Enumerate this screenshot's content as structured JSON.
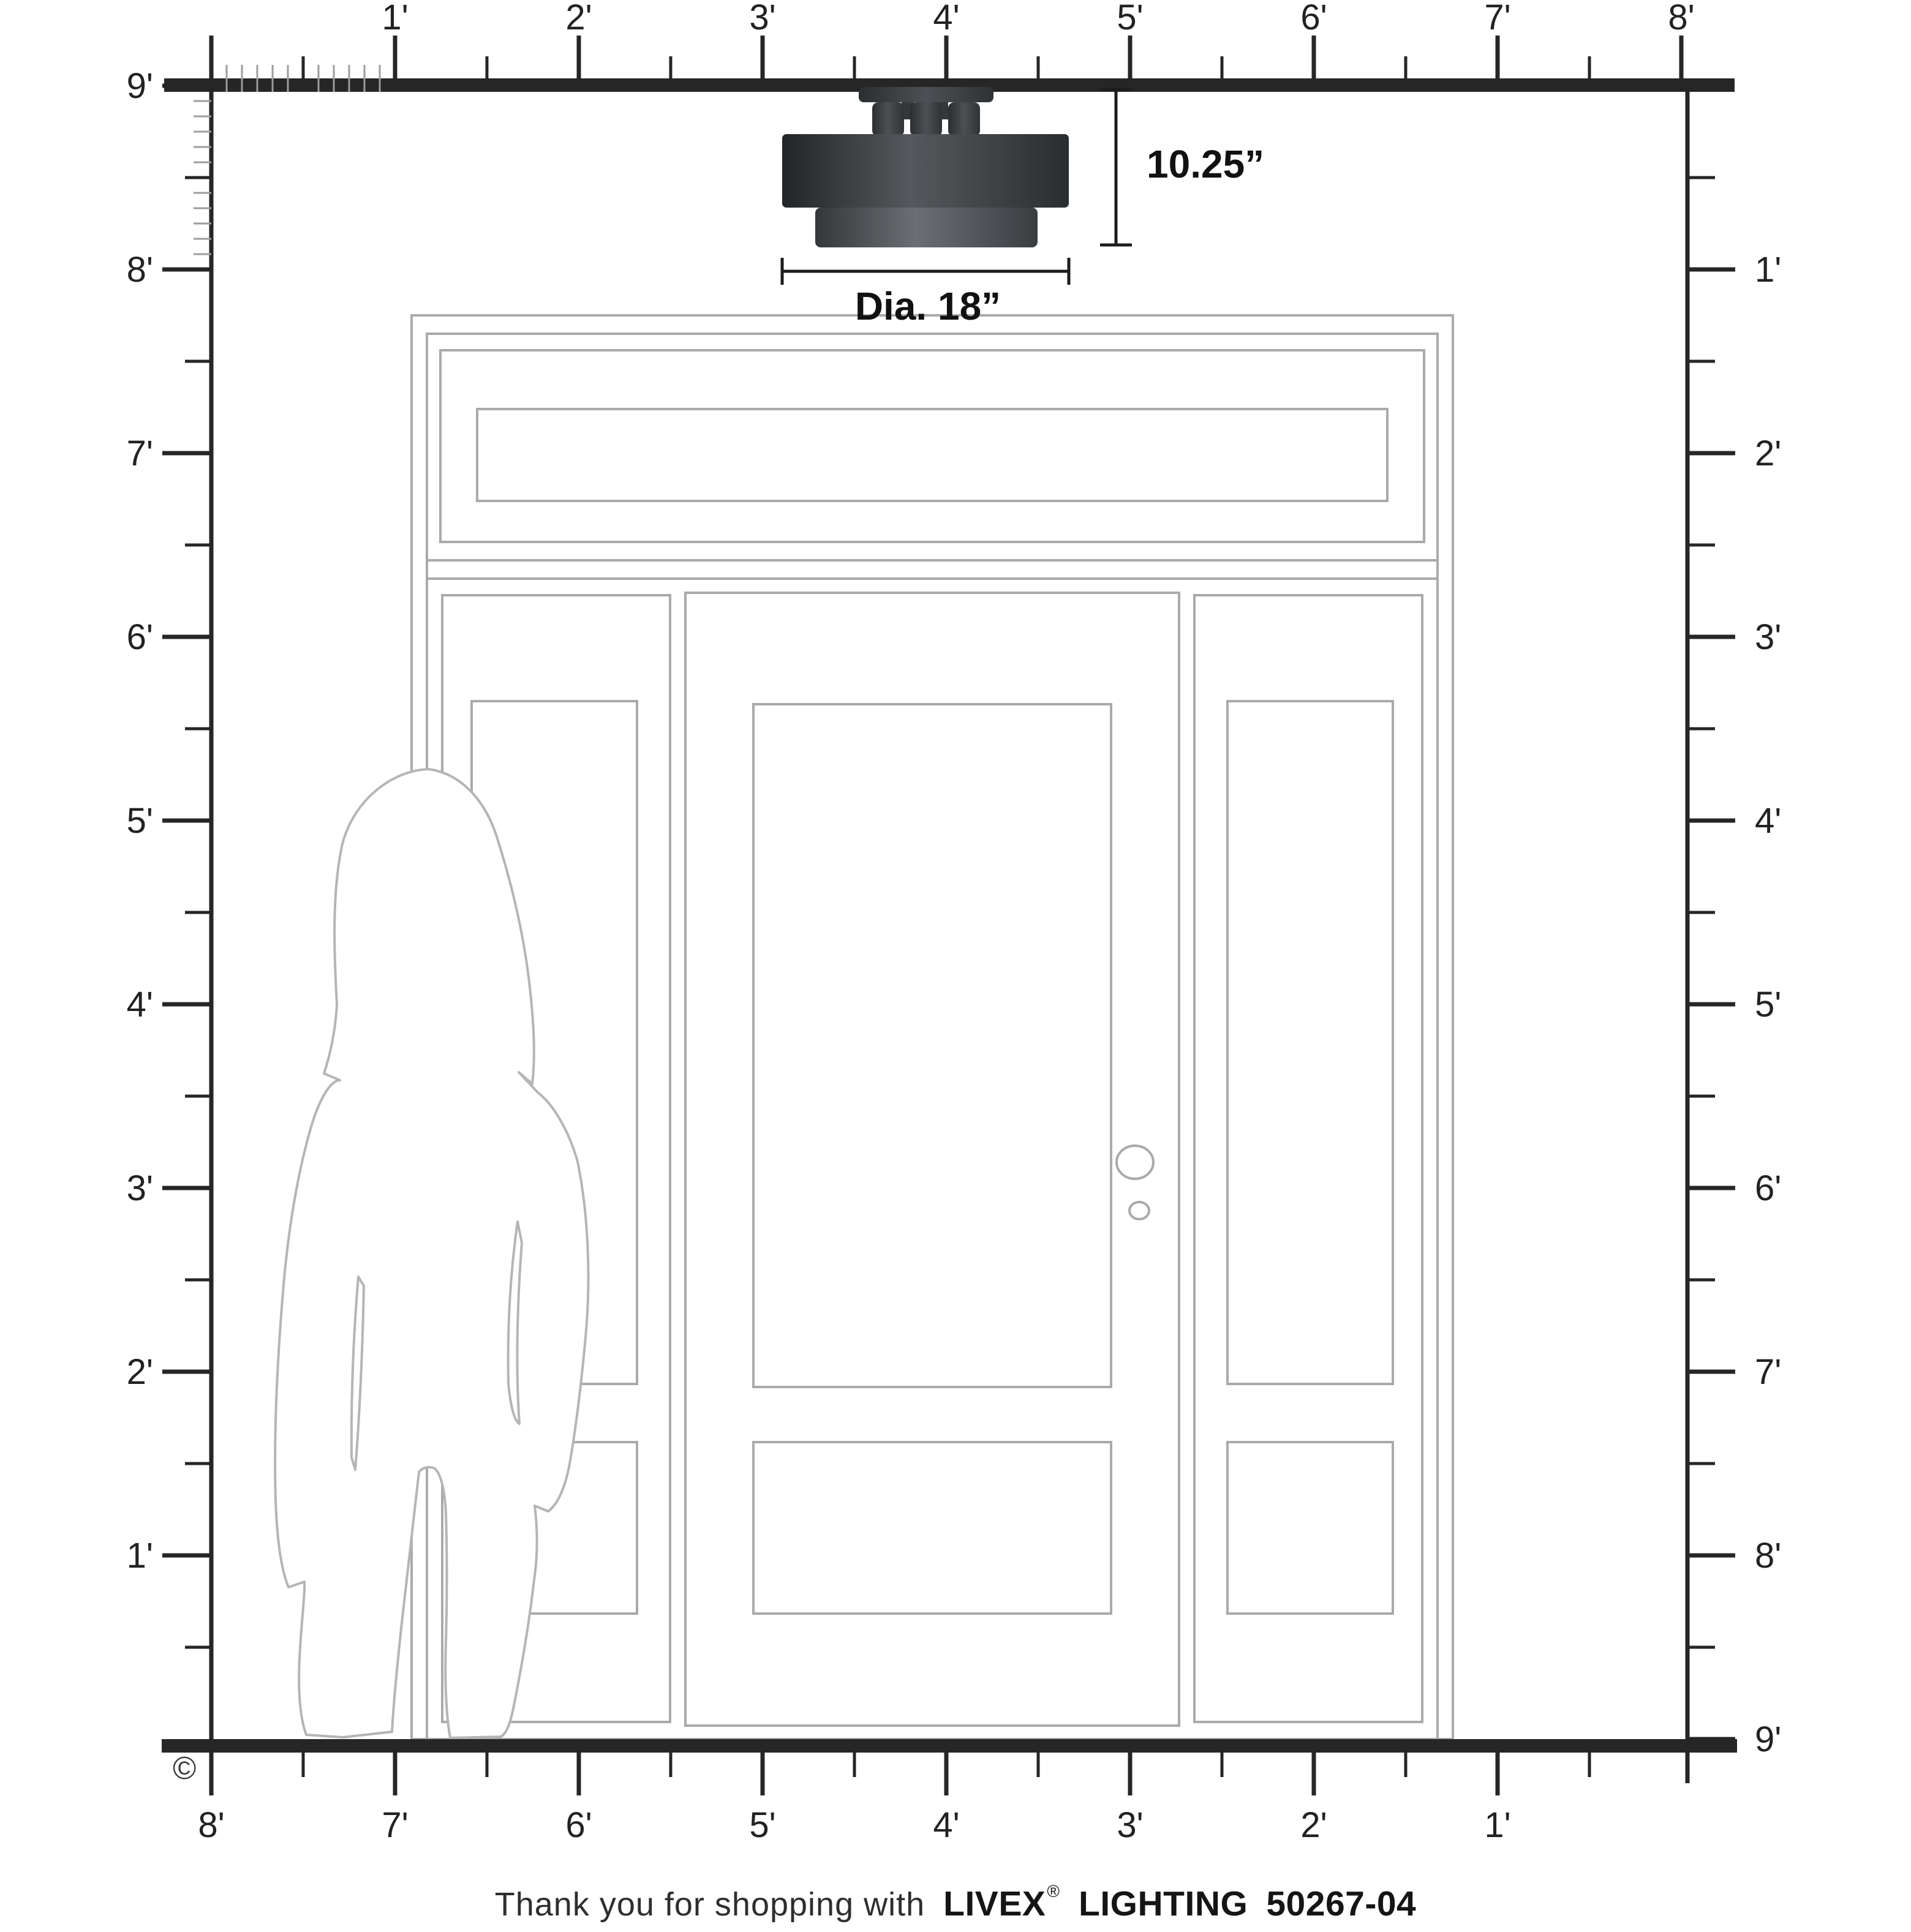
{
  "diagram": {
    "type": "product-scale-diagram",
    "grid_feet_span_horizontal": 8,
    "grid_feet_span_vertical": 9
  },
  "rulers": {
    "top": [
      "1'",
      "2'",
      "3'",
      "4'",
      "5'",
      "6'",
      "7'",
      "8'"
    ],
    "left": [
      "9'",
      "8'",
      "7'",
      "6'",
      "5'",
      "4'",
      "3'",
      "2'",
      "1'"
    ],
    "right": [
      "1'",
      "2'",
      "3'",
      "4'",
      "5'",
      "6'",
      "7'",
      "8'",
      "9'"
    ],
    "bottom": [
      "8'",
      "7'",
      "6'",
      "5'",
      "4'",
      "3'",
      "2'",
      "1'"
    ]
  },
  "fixture": {
    "height_label": "10.25”",
    "diameter_label": "Dia. 18”"
  },
  "footer": {
    "message": "Thank you for shopping with",
    "brand": "LIVEX",
    "registered_mark": "®",
    "product_line": "LIGHTING",
    "sku": "50267-04"
  },
  "copyright_symbol": "©",
  "colors": {
    "ruler": "#262626",
    "ruler_minor": "#9c9c9c",
    "door_outline": "#aaaaaa",
    "silhouette": "#b5b5b5",
    "fixture_dark": "#232527",
    "fixture_mid": "#55585c",
    "fixture_ring_mid": "#6b6f73",
    "dimension": "#1c1c1c"
  }
}
